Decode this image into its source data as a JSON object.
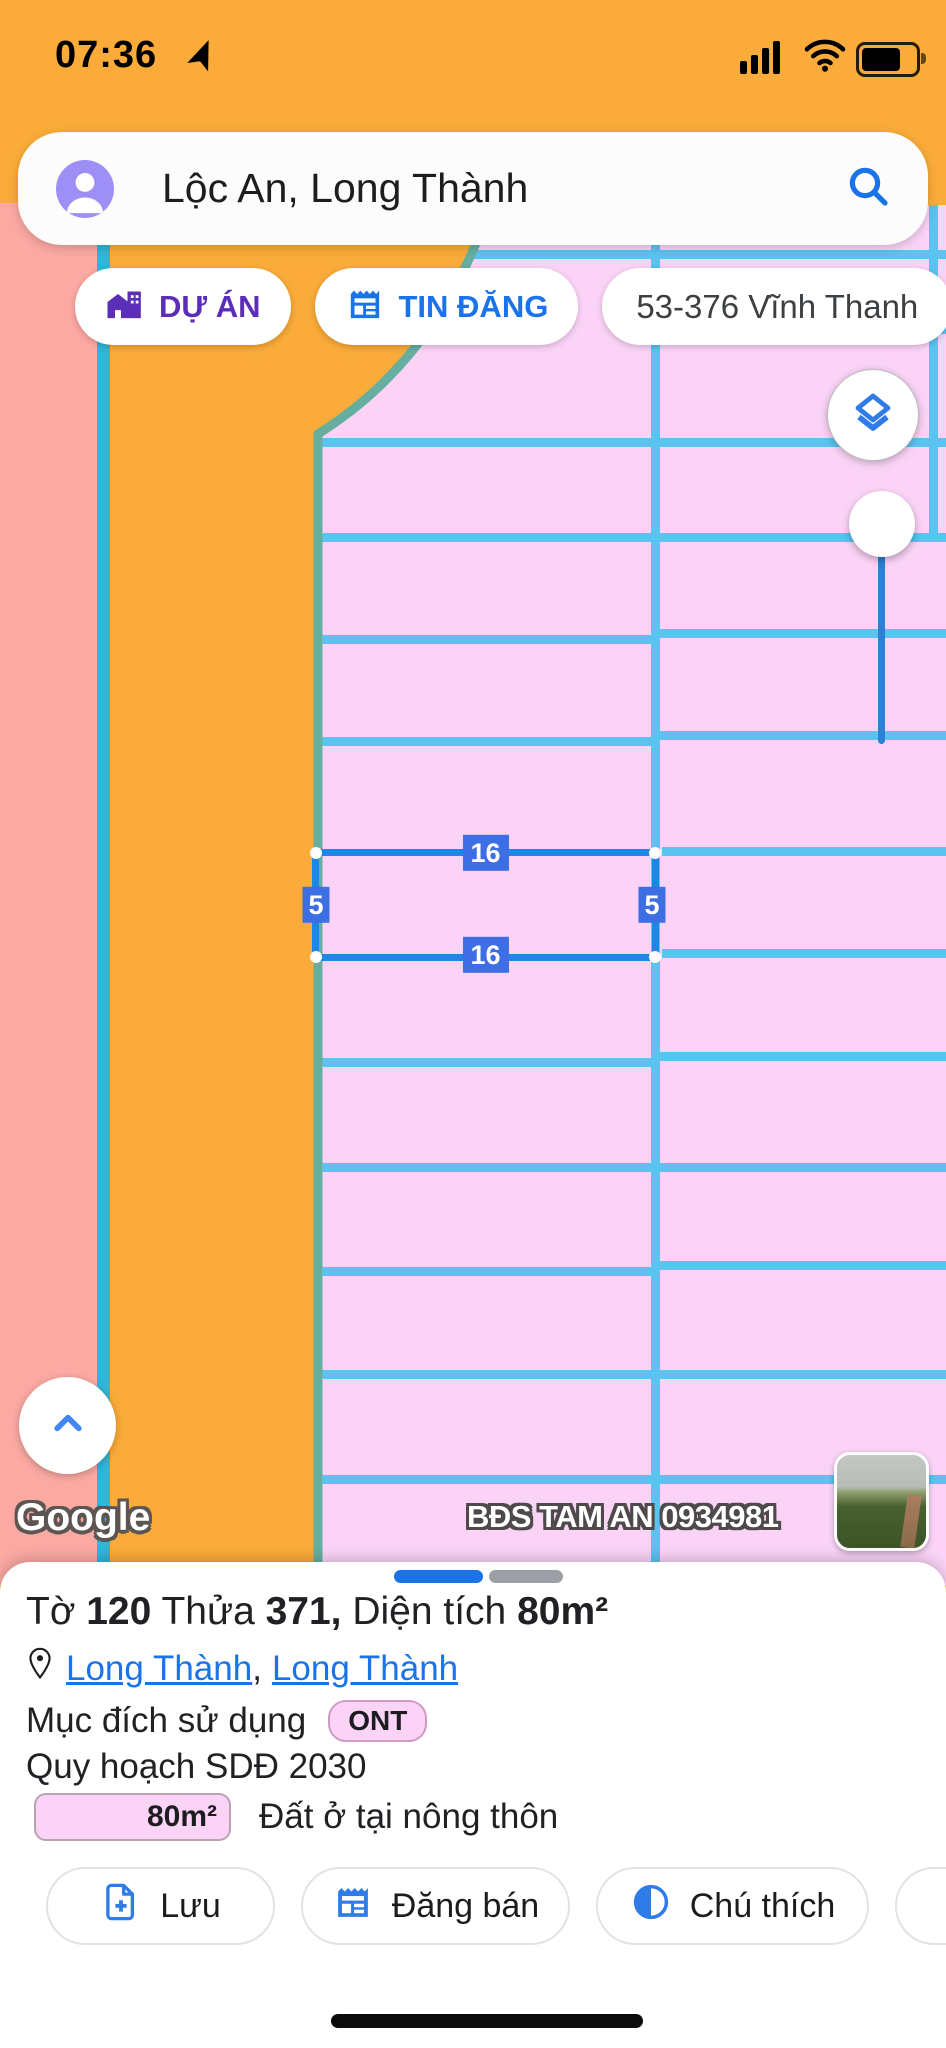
{
  "status_bar": {
    "time": "07:36"
  },
  "search_bar": {
    "query": "Lộc An, Long Thành"
  },
  "chips": {
    "du_an": "DỰ ÁN",
    "tin_dang": "TIN ĐĂNG",
    "address": "53-376 Vĩnh Thanh"
  },
  "map": {
    "parcel_labels": {
      "top": "16",
      "bottom": "16",
      "left": "5",
      "right": "5"
    },
    "watermark": "BĐS TAM AN 0934981",
    "attribution": "Google"
  },
  "sheet": {
    "title": {
      "p1": "Tờ ",
      "n1": "120",
      "p2": " Thửa ",
      "n2": "371,",
      "p3": " Diện tích ",
      "n3": "80m²"
    },
    "location": {
      "link1": "Long Thành",
      "sep": ", ",
      "link2": "Long Thành"
    },
    "purpose_label": "Mục đích sử dụng",
    "purpose_code": "ONT",
    "planning": "Quy hoạch SDĐ 2030",
    "area": "80m²",
    "area_desc": "Đất ở tại nông thôn",
    "buttons": {
      "save": "Lưu",
      "sell": "Đăng bán",
      "legend": "Chú thích"
    }
  },
  "colors": {
    "zone_pink": "#FBD3F7",
    "zone_orange": "#FAAB39",
    "zone_salmon": "#FBA9A2",
    "grid_blue": "#5BC3F0",
    "selection_blue": "#1C87E4",
    "measure_badge_blue": "#3E6EE3",
    "accent_blue": "#1A73E8",
    "project_purple": "#5B2EB8",
    "teal_border": "#66AFA0",
    "cyan_border": "#31B5DA"
  }
}
